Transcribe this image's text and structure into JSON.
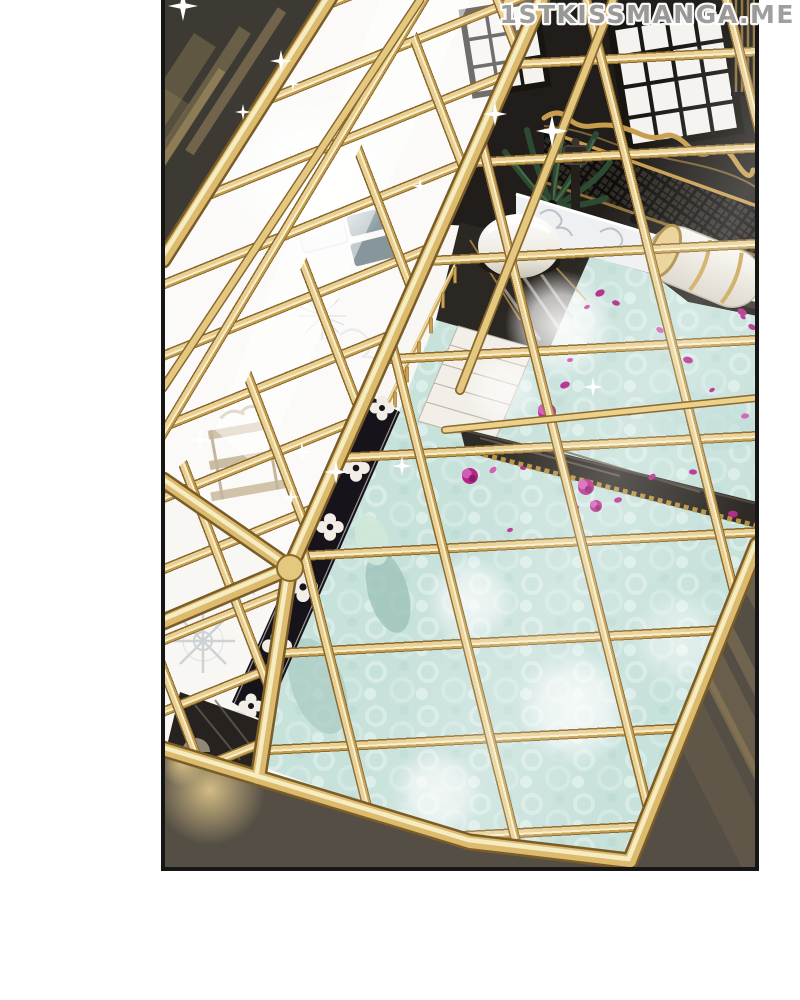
{
  "watermark": {
    "text": "1STKISSMANGA.ME",
    "color": "#9c9c9c"
  },
  "panel": {
    "border_color": "#161616",
    "bg": "#f8f7f3",
    "margin_color": "#ffffff"
  },
  "palette": {
    "gold_light": "#f6ecc2",
    "gold": "#dcbb6e",
    "gold_dark": "#8a682e",
    "water": "#c7e1db",
    "water_light": "#e3f2ee",
    "water_deep": "#a4c9c1",
    "petal": "#b5268b",
    "petal_dark": "#8c1a67",
    "petal_light": "#d35cb4",
    "marble_dark": "#2b2723",
    "tile_black": "#16131a",
    "wall_dark": "#3d3a34",
    "wall_mid": "#544e45",
    "interior_black": "#201d1a",
    "fence": "#2e2a24",
    "silver": "#bcc2cc",
    "palm": "#2c4a31",
    "white_floor": "#f8f7f4",
    "window_pane": "#f4f3ef",
    "window_frame": "#17150f"
  },
  "scene": {
    "description": "aerial view through golden glass conservatory roof onto luxury indoor pool with rose petals",
    "petals": [
      [
        547,
        412,
        9,
        "rose"
      ],
      [
        586,
        487,
        8,
        "rose"
      ],
      [
        470,
        476,
        8,
        "rose"
      ],
      [
        596,
        506,
        6,
        "rose"
      ],
      [
        565,
        385,
        5,
        "p"
      ],
      [
        630,
        412,
        5,
        "p"
      ],
      [
        688,
        360,
        5,
        "p"
      ],
      [
        742,
        312,
        5,
        "p"
      ],
      [
        752,
        327,
        4,
        "p"
      ],
      [
        600,
        293,
        5,
        "p"
      ],
      [
        616,
        303,
        4,
        "p"
      ],
      [
        693,
        472,
        4,
        "p"
      ],
      [
        733,
        514,
        5,
        "p"
      ],
      [
        745,
        416,
        4,
        "p"
      ],
      [
        652,
        477,
        4,
        "p"
      ],
      [
        618,
        500,
        4,
        "p"
      ],
      [
        575,
        507,
        4,
        "p"
      ],
      [
        523,
        468,
        3,
        "p"
      ],
      [
        493,
        470,
        4,
        "p"
      ],
      [
        510,
        530,
        3,
        "p"
      ],
      [
        556,
        450,
        3,
        "p"
      ],
      [
        660,
        330,
        4,
        "p"
      ],
      [
        712,
        390,
        3,
        "p"
      ],
      [
        570,
        360,
        3,
        "p"
      ],
      [
        587,
        307,
        3,
        "p"
      ],
      [
        743,
        317,
        3,
        "p"
      ]
    ],
    "sparkles": [
      [
        183,
        6,
        15
      ],
      [
        281,
        61,
        11
      ],
      [
        293,
        84,
        7
      ],
      [
        243,
        112,
        8
      ],
      [
        495,
        114,
        12
      ],
      [
        552,
        131,
        16
      ],
      [
        420,
        186,
        8
      ],
      [
        200,
        440,
        12
      ],
      [
        302,
        452,
        10
      ],
      [
        291,
        497,
        8
      ],
      [
        402,
        466,
        10
      ],
      [
        336,
        472,
        12
      ],
      [
        593,
        387,
        10
      ]
    ],
    "tile_flowers": [
      [
        382,
        408,
        1
      ],
      [
        356,
        468,
        1.1
      ],
      [
        330,
        527,
        1.1
      ],
      [
        303,
        587,
        1.2
      ],
      [
        277,
        646,
        1.2
      ],
      [
        251,
        706,
        1
      ]
    ],
    "rail_posts": [
      [
        455,
        268
      ],
      [
        443,
        293
      ],
      [
        431,
        318
      ],
      [
        419,
        342
      ],
      [
        407,
        367
      ],
      [
        395,
        392
      ],
      [
        383,
        417
      ],
      [
        371,
        442
      ]
    ],
    "glows": [
      [
        560,
        325,
        55,
        0.9
      ],
      [
        470,
        600,
        45,
        0.7
      ],
      [
        575,
        707,
        60,
        0.8
      ],
      [
        437,
        793,
        45,
        0.7
      ],
      [
        310,
        175,
        85,
        0.85
      ],
      [
        505,
        390,
        40,
        0.6
      ],
      [
        680,
        640,
        50,
        0.5
      ]
    ],
    "rays_topleft": [
      [
        205,
        40,
        270,
        26,
        0.3
      ],
      [
        245,
        30,
        240,
        14,
        0.38
      ],
      [
        175,
        95,
        310,
        34,
        0.22
      ],
      [
        282,
        10,
        170,
        10,
        0.45
      ],
      [
        222,
        70,
        290,
        8,
        0.5
      ]
    ],
    "rays_bottom": [
      [
        660,
        560,
        320,
        26,
        0.25
      ],
      [
        700,
        575,
        320,
        12,
        0.35
      ],
      [
        628,
        600,
        300,
        40,
        0.15
      ],
      [
        737,
        555,
        300,
        18,
        0.28
      ],
      [
        688,
        640,
        260,
        8,
        0.38
      ]
    ]
  }
}
